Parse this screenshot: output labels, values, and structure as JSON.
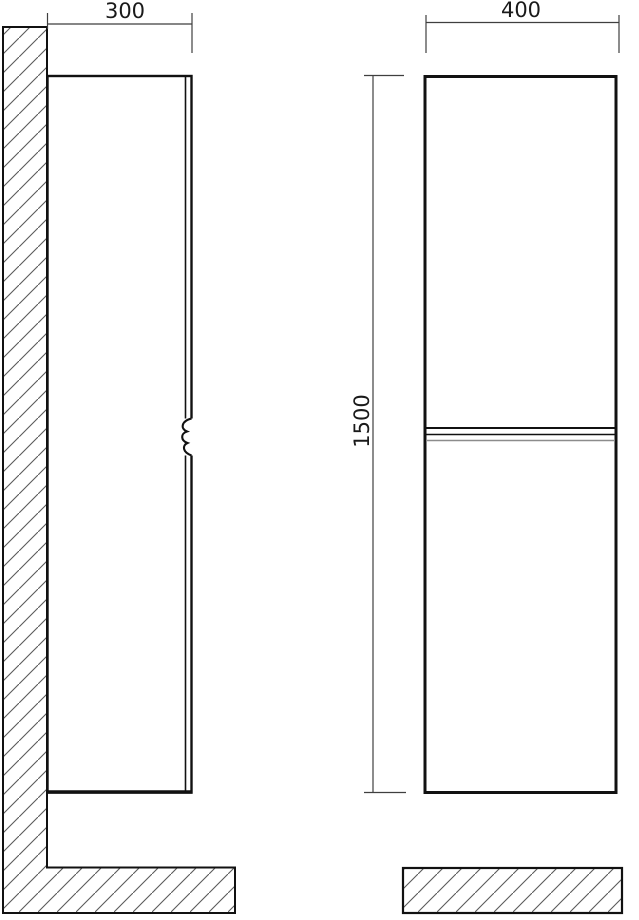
{
  "dimensions": {
    "depth": "300",
    "width": "400",
    "height": "1500"
  },
  "colors": {
    "line": "#111111",
    "dimension": "#3f3f3f",
    "hatch": "#5a5a5a",
    "shadow": "#8c8c8c",
    "background": "#ffffff",
    "text": "#1a1a1a"
  }
}
